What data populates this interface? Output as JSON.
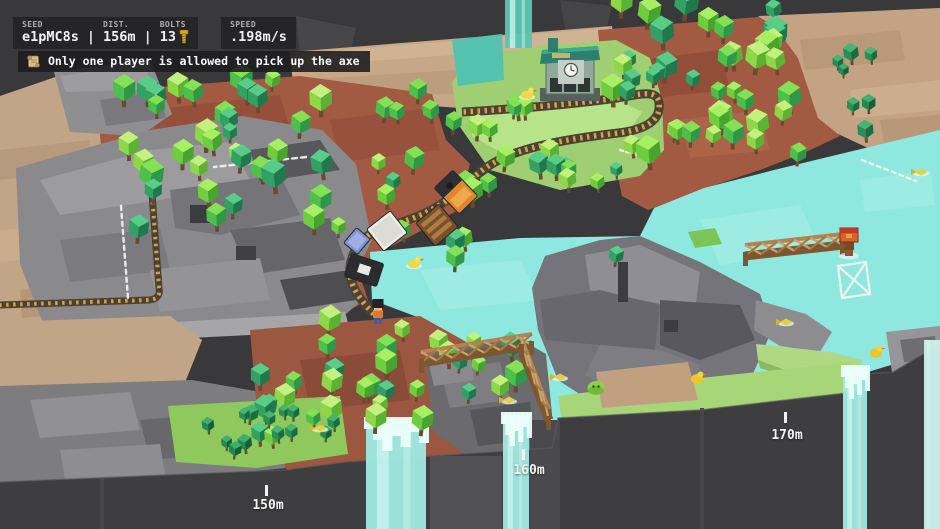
{
  "hud": {
    "stats": {
      "seed_label": "SEED",
      "seed_value": "e1pMC8s",
      "sep1": "|",
      "dist_label": "DIST.",
      "dist_value": "156m",
      "sep2": "|",
      "bolts_label": "BOLTS",
      "bolts_value": "13"
    },
    "speed": {
      "label": "SPEED",
      "value": ".198m/s"
    },
    "message": {
      "icon": "scroll-icon",
      "text": "Only one player is allowed to pick up the axe"
    }
  },
  "markers": [
    {
      "label": "150m",
      "x": 268,
      "y": 498,
      "tick_x": 265,
      "tick_y": 485
    },
    {
      "label": "160m",
      "x": 529,
      "y": 463,
      "tick_x": 522,
      "tick_y": 449
    },
    {
      "label": "170m",
      "x": 787,
      "y": 428,
      "tick_x": 784,
      "tick_y": 412
    }
  ],
  "colors": {
    "void": "#39393b",
    "cliff": "#3e3e41",
    "water": "#8fe8df",
    "water_light": "#a9efe7",
    "dirt": "#a25a42",
    "sand": "#c6a888",
    "rock": "#8a8a8c",
    "grass": "#9fcf72",
    "track_gold": "#d9a33b",
    "track_tie": "#4a4138",
    "wood": "#b5834f",
    "wood_dark": "#7d5731",
    "chalk": "#f4f3ee",
    "hud_bg": "#242427",
    "hud_text": "#f2f2f2",
    "hud_label": "#b0b0b0",
    "bolt_gold": "#d8a62a",
    "foam": "#ecfffb"
  },
  "scene": {
    "tree_palettes": {
      "trunk": "#6b4930",
      "mixed": [
        {
          "top": "#a9ef64",
          "side": "#6fce40",
          "dark": "#47a42e"
        },
        {
          "top": "#84e055",
          "side": "#4cc04a",
          "dark": "#2f9848"
        },
        {
          "top": "#58cc88",
          "side": "#33a064",
          "dark": "#20794c"
        },
        {
          "top": "#c3f07e",
          "side": "#8cd848",
          "dark": "#5cb232"
        }
      ],
      "dark": [
        {
          "top": "#46b472",
          "side": "#2a8f54",
          "dark": "#1b6c40"
        },
        {
          "top": "#3fae6e",
          "side": "#268750",
          "dark": "#175f38"
        }
      ]
    },
    "tree_clusters": [
      {
        "name": "forest-top-left",
        "x": 118,
        "y": 82,
        "w": 240,
        "h": 150,
        "count": 36,
        "rmin": 8,
        "rmax": 14,
        "seed": 11,
        "palette": "mixed"
      },
      {
        "name": "forest-center",
        "x": 378,
        "y": 92,
        "w": 180,
        "h": 170,
        "count": 24,
        "rmin": 8,
        "rmax": 13,
        "seed": 22,
        "palette": "mixed"
      },
      {
        "name": "forest-top-right",
        "x": 612,
        "y": 2,
        "w": 195,
        "h": 162,
        "count": 42,
        "rmin": 8,
        "rmax": 14,
        "seed": 33,
        "palette": "mixed"
      },
      {
        "name": "forest-bottom-left",
        "x": 258,
        "y": 322,
        "w": 258,
        "h": 138,
        "count": 32,
        "rmin": 8,
        "rmax": 13,
        "seed": 44,
        "palette": "mixed"
      },
      {
        "name": "grove-bottom-strip",
        "x": 172,
        "y": 402,
        "w": 164,
        "h": 50,
        "count": 13,
        "rmin": 6,
        "rmax": 9,
        "seed": 55,
        "palette": "dark"
      },
      {
        "name": "grove-mid-right",
        "x": 556,
        "y": 168,
        "w": 70,
        "h": 92,
        "count": 7,
        "rmin": 7,
        "rmax": 11,
        "seed": 66,
        "palette": "mixed"
      },
      {
        "name": "grove-right-edge",
        "x": 836,
        "y": 52,
        "w": 36,
        "h": 92,
        "count": 7,
        "rmin": 6,
        "rmax": 10,
        "seed": 77,
        "palette": "dark"
      }
    ],
    "train": {
      "cars": [
        {
          "name": "dark-wagon",
          "cx": 364,
          "cy": 270,
          "w": 24,
          "h": 34,
          "angle": -72,
          "body": "#2b2b30",
          "roof": "#3c3c44",
          "type": "darkcar"
        },
        {
          "name": "blue-wagon",
          "cx": 357,
          "cy": 241,
          "w": 20,
          "h": 18,
          "angle": -50,
          "body": "#8093d8",
          "roof": "#aab6e8",
          "type": "plain"
        },
        {
          "name": "white-wagon",
          "cx": 387,
          "cy": 231,
          "w": 30,
          "h": 28,
          "angle": -38,
          "body": "#efeee6",
          "roof": "#d8d7cd",
          "type": "plain"
        },
        {
          "name": "crafting-wagon",
          "cx": 437,
          "cy": 225,
          "w": 30,
          "h": 30,
          "angle": -40,
          "body": "#7c5029",
          "roof": "#aa7c46",
          "type": "planks"
        },
        {
          "name": "locomotive",
          "cx": 456,
          "cy": 192,
          "w": 26,
          "h": 36,
          "angle": -44,
          "body": "#e2862c",
          "roof": "#2e2e33",
          "type": "loco"
        }
      ]
    },
    "players": [
      {
        "name": "player-one",
        "kind": "person",
        "x": 378,
        "y": 316
      },
      {
        "name": "player-two-with-crate",
        "kind": "crate-carrier",
        "x": 849,
        "y": 248
      }
    ],
    "animals": [
      {
        "type": "duck",
        "x": 414,
        "y": 264
      },
      {
        "type": "duck",
        "x": 527,
        "y": 95
      },
      {
        "type": "fish",
        "x": 560,
        "y": 377
      },
      {
        "type": "fish",
        "x": 509,
        "y": 400
      },
      {
        "type": "fish",
        "x": 921,
        "y": 172
      },
      {
        "type": "fish",
        "x": 786,
        "y": 322
      },
      {
        "type": "fish",
        "x": 320,
        "y": 428
      },
      {
        "type": "slime",
        "x": 596,
        "y": 388
      },
      {
        "type": "chick",
        "x": 697,
        "y": 379
      },
      {
        "type": "chick",
        "x": 876,
        "y": 353
      }
    ],
    "waterfalls": [
      {
        "name": "waterfall-top",
        "x": 505,
        "w": 27,
        "top": 0,
        "bottom": 48,
        "foam": false,
        "color": "#57c6b2"
      },
      {
        "name": "waterfall-bottom-left",
        "x": 366,
        "w": 60,
        "top": 420,
        "foam": true,
        "color": "#9fe8e0"
      },
      {
        "name": "waterfall-bottom-mid",
        "x": 503,
        "w": 26,
        "top": 415,
        "foam": true,
        "color": "#9fe8e0"
      },
      {
        "name": "waterfall-bottom-right",
        "x": 843,
        "w": 24,
        "top": 368,
        "foam": true,
        "color": "#9fe8e0"
      },
      {
        "name": "waterfall-right-edge",
        "x": 924,
        "w": 16,
        "top": 340,
        "foam": false,
        "color": "#cfeeea"
      }
    ],
    "bridges": [
      {
        "name": "bridge-lake-left",
        "x1": 421,
        "y1": 359,
        "x2": 532,
        "y2": 341
      },
      {
        "name": "bridge-lake-left-down",
        "x1": 521,
        "y1": 344,
        "x2": 549,
        "y2": 416
      },
      {
        "name": "bridge-right",
        "x1": 745,
        "y1": 252,
        "x2": 843,
        "y2": 241
      }
    ],
    "chalk_marks": [
      {
        "name": "route-chalk-top",
        "d": "M 306,157 L 214,167",
        "dash": "5 4"
      },
      {
        "name": "route-chalk-left",
        "d": "M 121,206 L 128,298",
        "dash": "4 4"
      },
      {
        "name": "rock-chalk-1",
        "d": "M 427,351 L 471,343",
        "dash": "6 3"
      },
      {
        "name": "rock-chalk-2",
        "d": "M 430,362 L 473,354",
        "dash": "6 3"
      },
      {
        "name": "chalk-near-bend",
        "d": "M 620,150 L 650,159",
        "dash": "3 3"
      },
      {
        "name": "route-chalk-right",
        "d": "M 862,160 L 916,181",
        "dash": "4 4"
      },
      {
        "name": "ghost-bridge-outline",
        "d": "M 838,266 L 866,262 L 870,294 L 842,298 Z M 838,266 L 870,294 M 866,262 L 842,298",
        "dash": "3 2"
      }
    ]
  }
}
